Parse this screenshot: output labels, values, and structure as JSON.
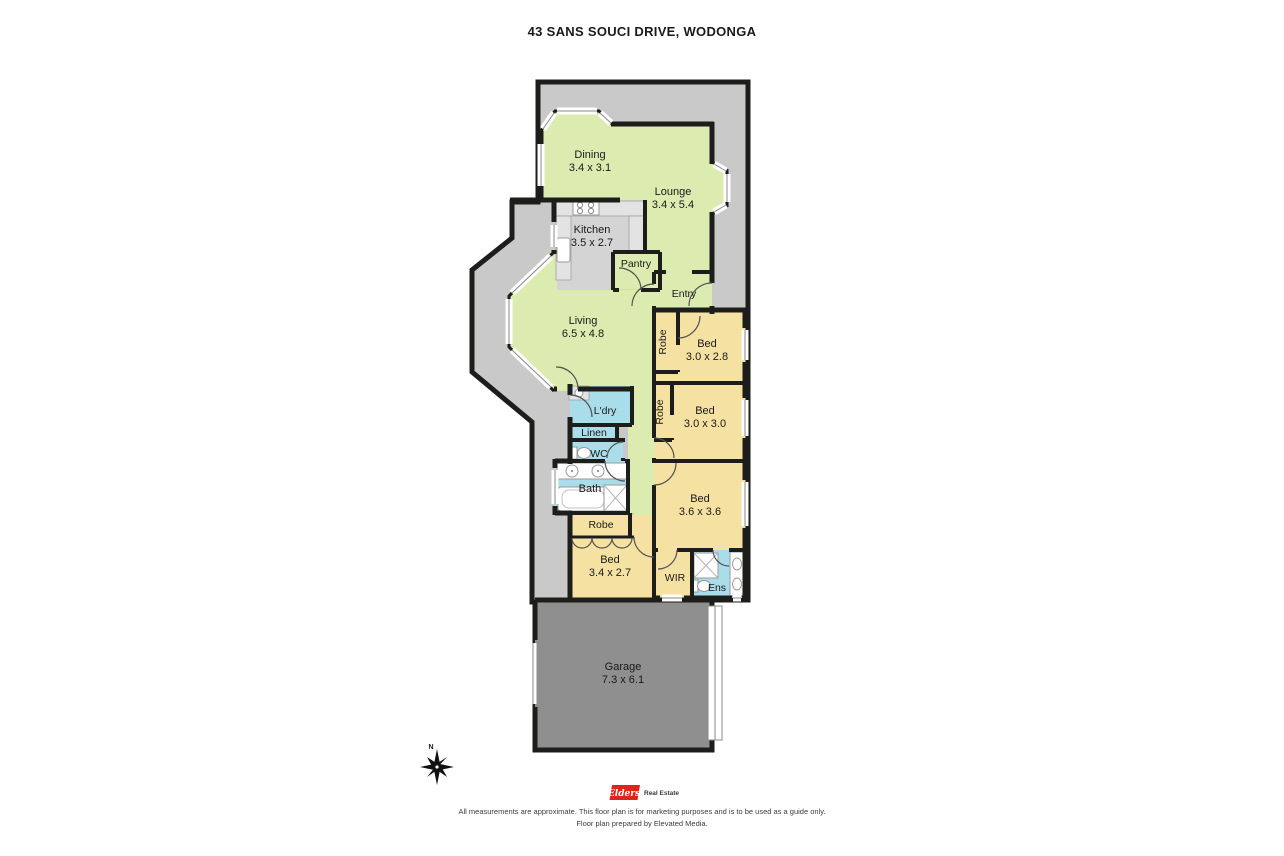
{
  "header": {
    "title": "43 SANS SOUCI DRIVE, WODONGA"
  },
  "rooms": {
    "dining": {
      "name": "Dining",
      "dims": "3.4 x 3.1"
    },
    "lounge": {
      "name": "Lounge",
      "dims": "3.4 x 5.4"
    },
    "kitchen": {
      "name": "Kitchen",
      "dims": "3.5 x 2.7"
    },
    "pantry": {
      "name": "Pantry"
    },
    "entry": {
      "name": "Entry"
    },
    "living": {
      "name": "Living",
      "dims": "6.5 x 4.8"
    },
    "robe1": {
      "name": "Robe"
    },
    "bed1": {
      "name": "Bed",
      "dims": "3.0 x 2.8"
    },
    "robe2": {
      "name": "Robe"
    },
    "bed2": {
      "name": "Bed",
      "dims": "3.0 x 3.0"
    },
    "laundry": {
      "name": "L'dry"
    },
    "linen": {
      "name": "Linen"
    },
    "wc": {
      "name": "WC"
    },
    "bath": {
      "name": "Bath"
    },
    "robe3": {
      "name": "Robe"
    },
    "bed4": {
      "name": "Bed",
      "dims": "3.4 x 2.7"
    },
    "bed3": {
      "name": "Bed",
      "dims": "3.6 x 3.6"
    },
    "wir": {
      "name": "WIR"
    },
    "ens": {
      "name": "Ens"
    },
    "garage": {
      "name": "Garage",
      "dims": "7.3 x 6.1"
    }
  },
  "compass": {
    "label": "N"
  },
  "footer": {
    "brand": "Elders",
    "brand_suffix": "Real Estate",
    "disclaimer_line1": "All measurements are approximate. This floor plan is for marketing purposes and is to be used as a guide only.",
    "disclaimer_line2": "Floor plan prepared by Elevated Media."
  },
  "colors": {
    "living_area": "#dcebb0",
    "bedroom": "#f5e2a2",
    "wet_area": "#a9dde9",
    "verandah": "#c9c9c9",
    "garage": "#8f8f8f",
    "wall": "#1d1d1b",
    "brand_red": "#e2231a"
  }
}
